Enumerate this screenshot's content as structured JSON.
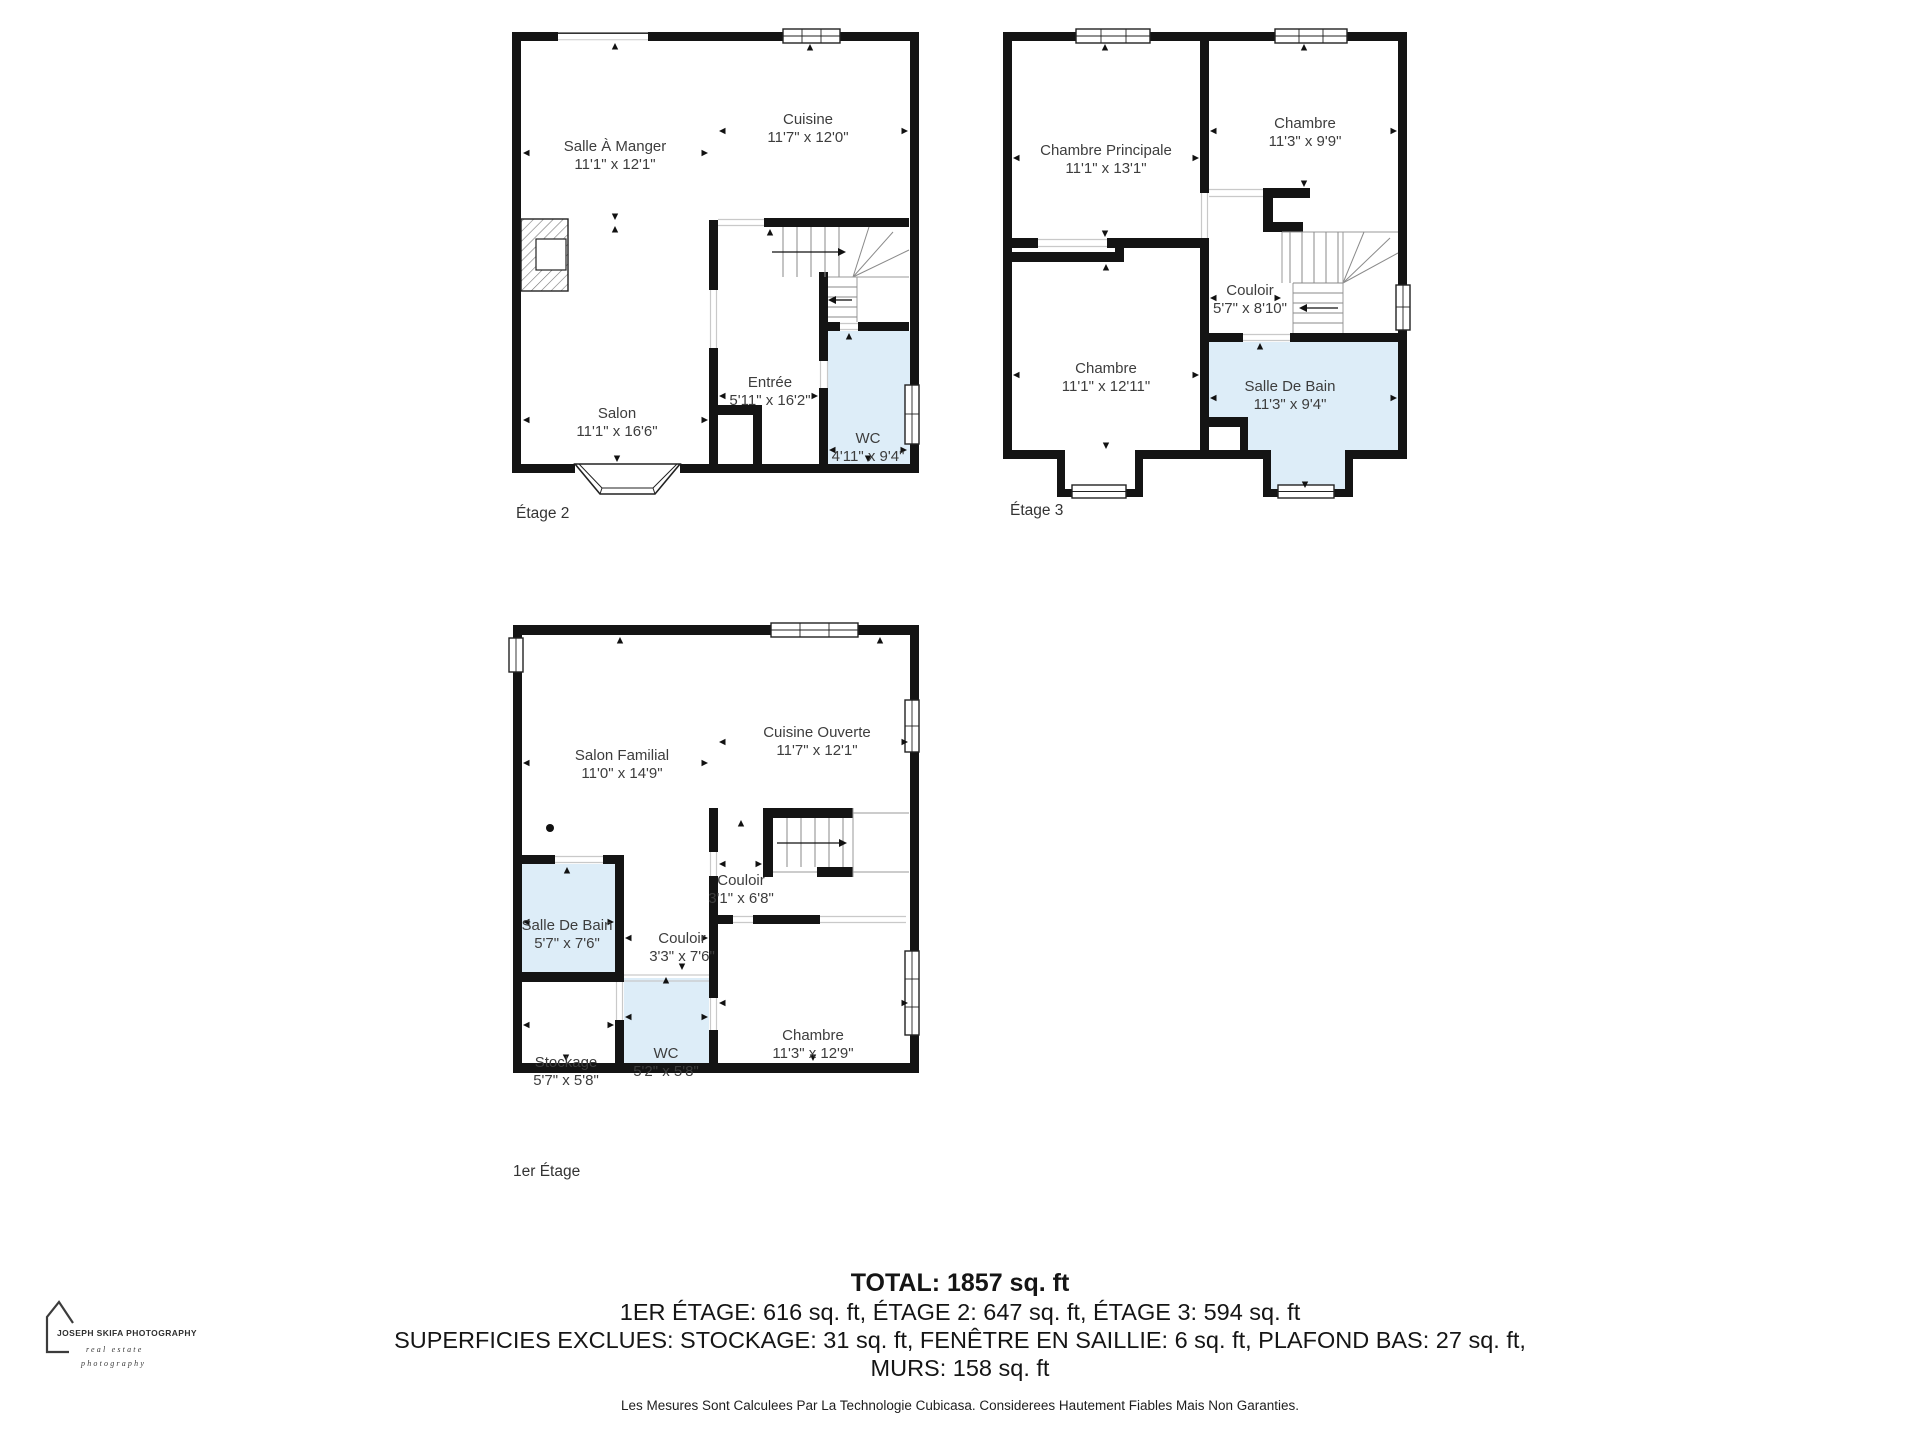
{
  "floors": [
    {
      "label": "Étage 2",
      "rooms": [
        {
          "name": "Salle À Manger",
          "dims": "11'1\" x 12'1\""
        },
        {
          "name": "Cuisine",
          "dims": "11'7\" x 12'0\""
        },
        {
          "name": "Salon",
          "dims": "11'1\" x 16'6\""
        },
        {
          "name": "Entrée",
          "dims": "5'11\" x 16'2\""
        },
        {
          "name": "WC",
          "dims": "4'11\" x 9'4\""
        }
      ]
    },
    {
      "label": "Étage 3",
      "rooms": [
        {
          "name": "Chambre Principale",
          "dims": "11'1\" x 13'1\""
        },
        {
          "name": "Chambre",
          "dims": "11'3\" x 9'9\""
        },
        {
          "name": "Couloir",
          "dims": "5'7\" x 8'10\""
        },
        {
          "name": "Chambre",
          "dims": "11'1\" x 12'11\""
        },
        {
          "name": "Salle De Bain",
          "dims": "11'3\" x 9'4\""
        }
      ]
    },
    {
      "label": "1er Étage",
      "rooms": [
        {
          "name": "Salon Familial",
          "dims": "11'0\" x 14'9\""
        },
        {
          "name": "Cuisine Ouverte",
          "dims": "11'7\" x 12'1\""
        },
        {
          "name": "Couloir",
          "dims": "3'1\" x 6'8\""
        },
        {
          "name": "Couloir",
          "dims": "3'3\" x 7'6\""
        },
        {
          "name": "Salle De Bain",
          "dims": "5'7\" x 7'6\""
        },
        {
          "name": "Stockage",
          "dims": "5'7\" x 5'8\""
        },
        {
          "name": "WC",
          "dims": "5'2\" x 5'8\""
        },
        {
          "name": "Chambre",
          "dims": "11'3\" x 12'9\""
        }
      ]
    }
  ],
  "summary": {
    "total": "TOTAL: 1857 sq. ft",
    "floors_line": "1ER ÉTAGE: 616 sq. ft, ÉTAGE 2: 647 sq. ft, ÉTAGE 3: 594 sq. ft",
    "exclusions_line": "SUPERFICIES EXCLUES: STOCKAGE: 31 sq. ft, FENÊTRE EN SAILLIE: 6 sq. ft, PLAFOND BAS: 27 sq. ft,",
    "exclusions_line2": "MURS: 158 sq. ft",
    "disclaimer": "Les Mesures Sont Calculees Par La Technologie Cubicasa. Considerees Hautement Fiables Mais Non Garanties."
  },
  "logo": {
    "brand": "JOSEPH SKIFA PHOTOGRAPHY",
    "tagline1": "real estate",
    "tagline2": "photography"
  },
  "colors": {
    "wall": "#141414",
    "wet_room_fill": "#ddedf8"
  }
}
